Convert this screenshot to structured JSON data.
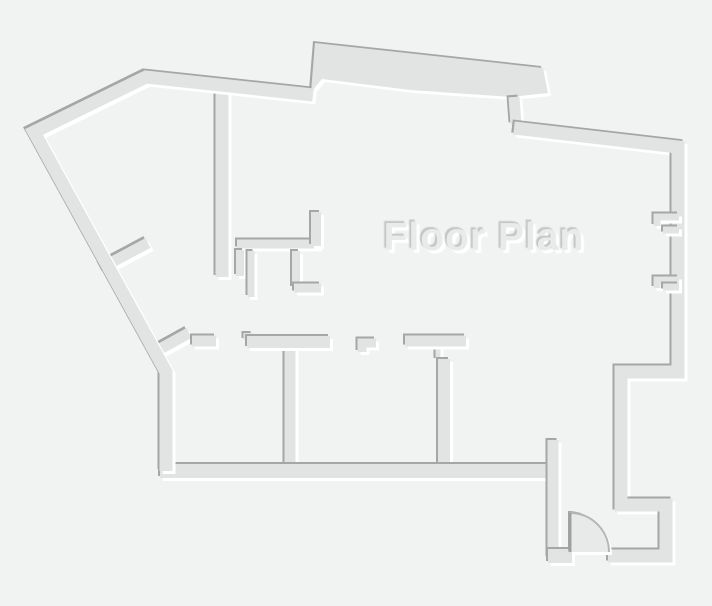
{
  "title": {
    "text": "Floor Plan"
  },
  "colors": {
    "background": "#f1f2f2",
    "wall_fill": "#e2e4e4",
    "wall_shadow": "#a4a6a7",
    "wall_highlight": "#ffffff",
    "title_fill": "#e9ebeb",
    "title_shadow": "#c3c5c6",
    "door_swing_fill": "#e8eaea",
    "door_arc_stroke": "#b4b6b7",
    "door_leaf_stroke": "#9ea0a1"
  }
}
